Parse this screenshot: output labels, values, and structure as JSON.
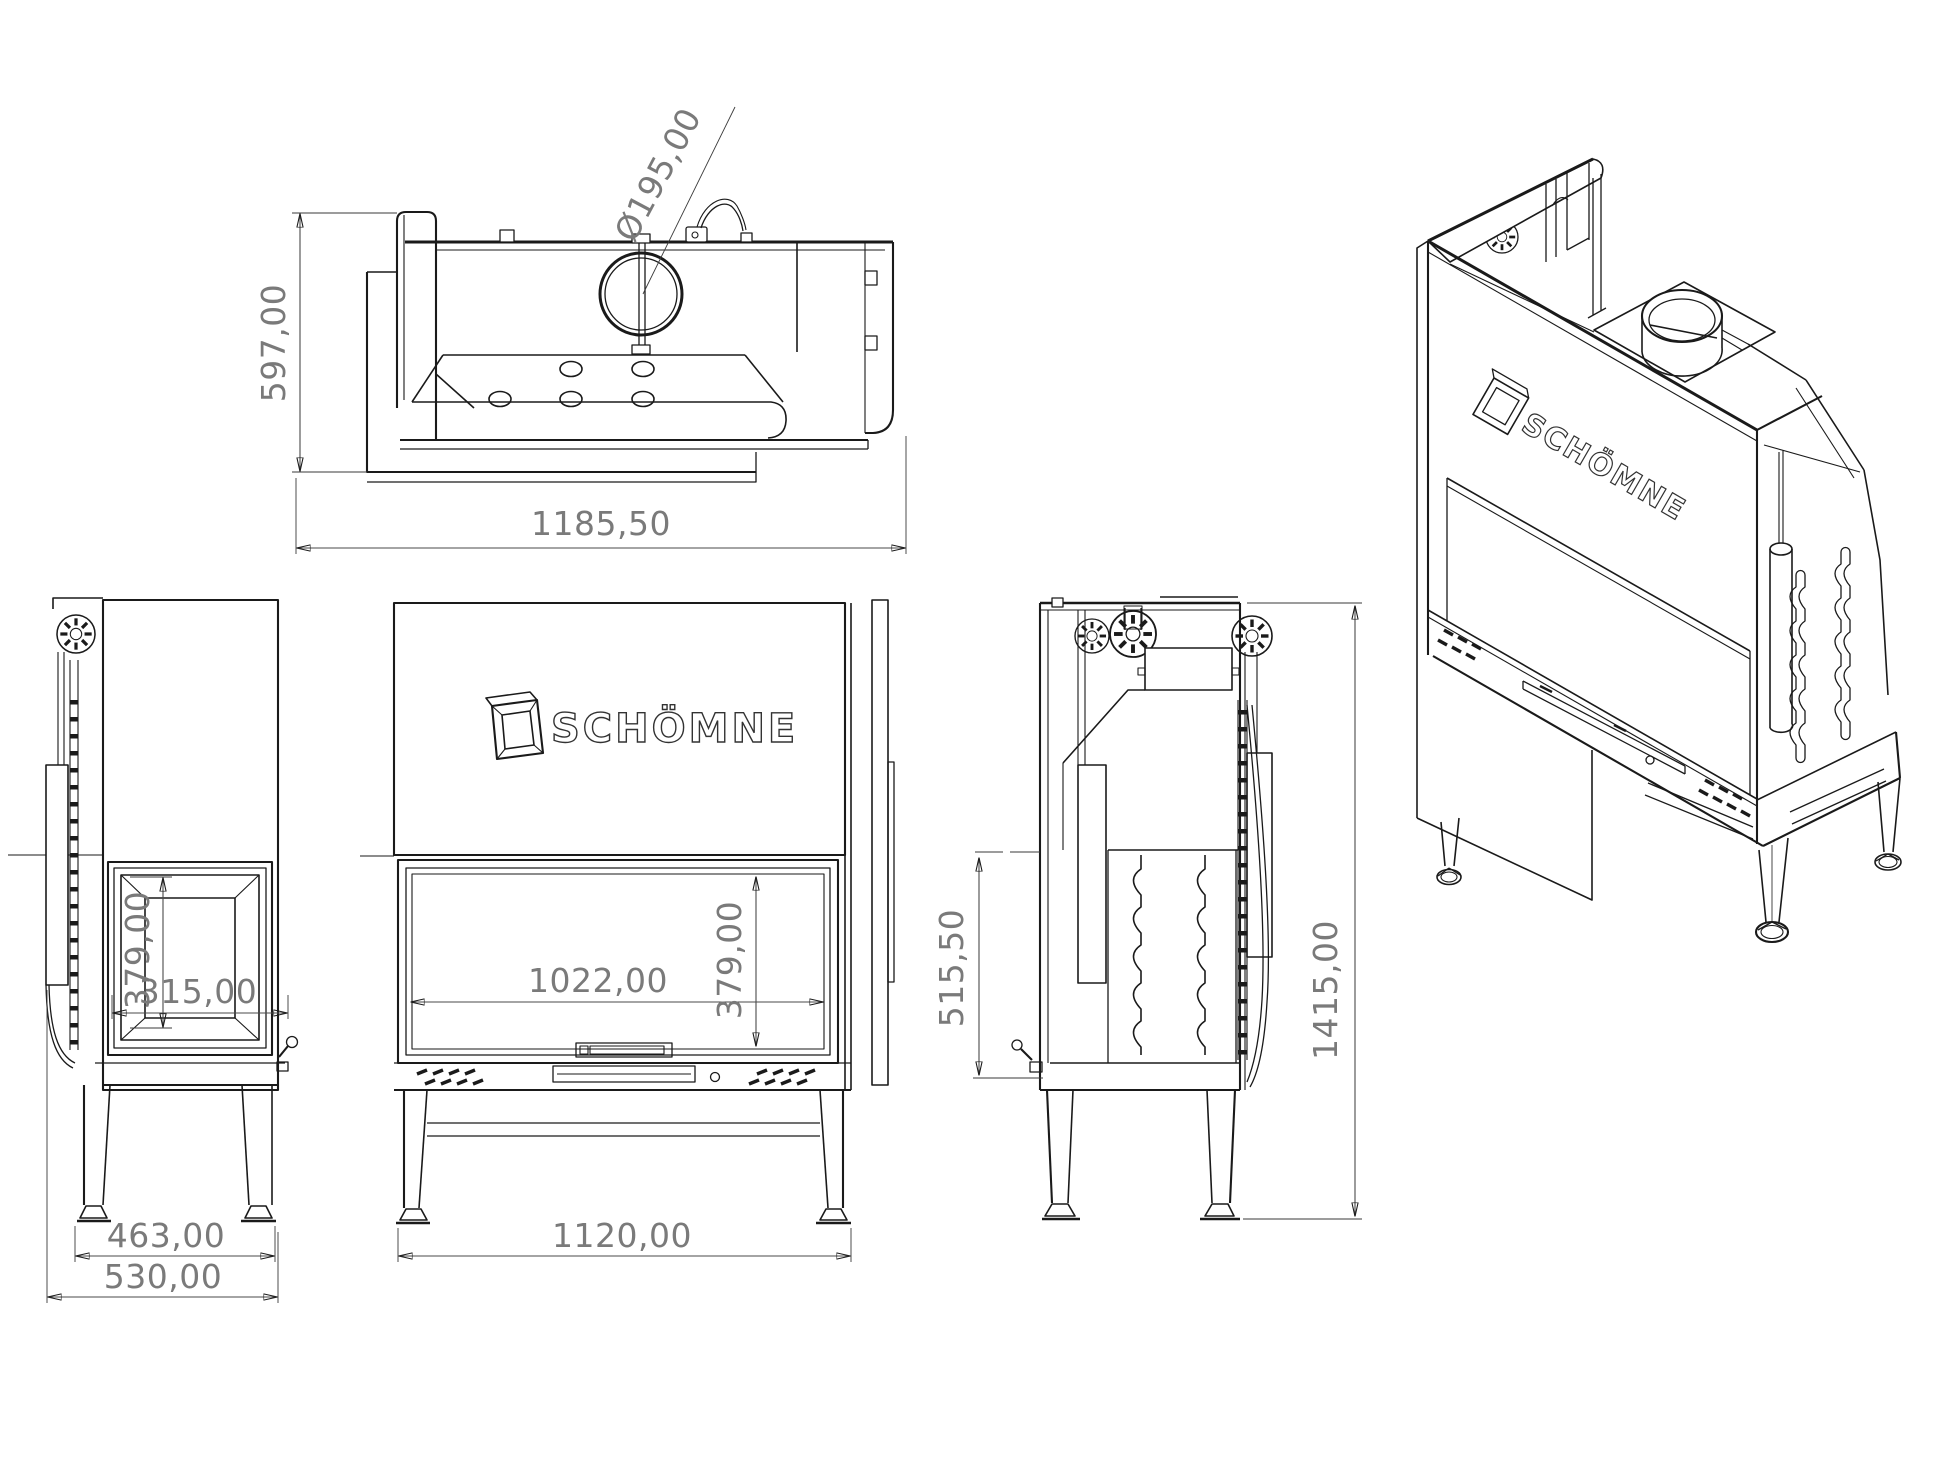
{
  "brand": "SCHÖMNE",
  "views": {
    "top": {
      "label_height": "597,00",
      "label_width": "1185,50",
      "label_flue": "Ø195,00"
    },
    "side_left": {
      "label_glass_height": "379,00",
      "label_glass_width": "315,00",
      "label_leg_span": "463,00",
      "label_depth": "530,00"
    },
    "front": {
      "label_glass_width": "1022,00",
      "label_glass_height": "379,00",
      "label_width": "1120,00",
      "logo": "SCHÖMNE"
    },
    "side_right": {
      "label_firebox_height": "515,50",
      "label_total_height": "1415,00"
    },
    "isometric": {
      "logo": "SCHÖMNE"
    }
  },
  "colors": {
    "line": "#1a1a1a",
    "dimension_text": "#7a7a7a",
    "dimension_line": "#4a4a4a",
    "background": "#ffffff"
  }
}
